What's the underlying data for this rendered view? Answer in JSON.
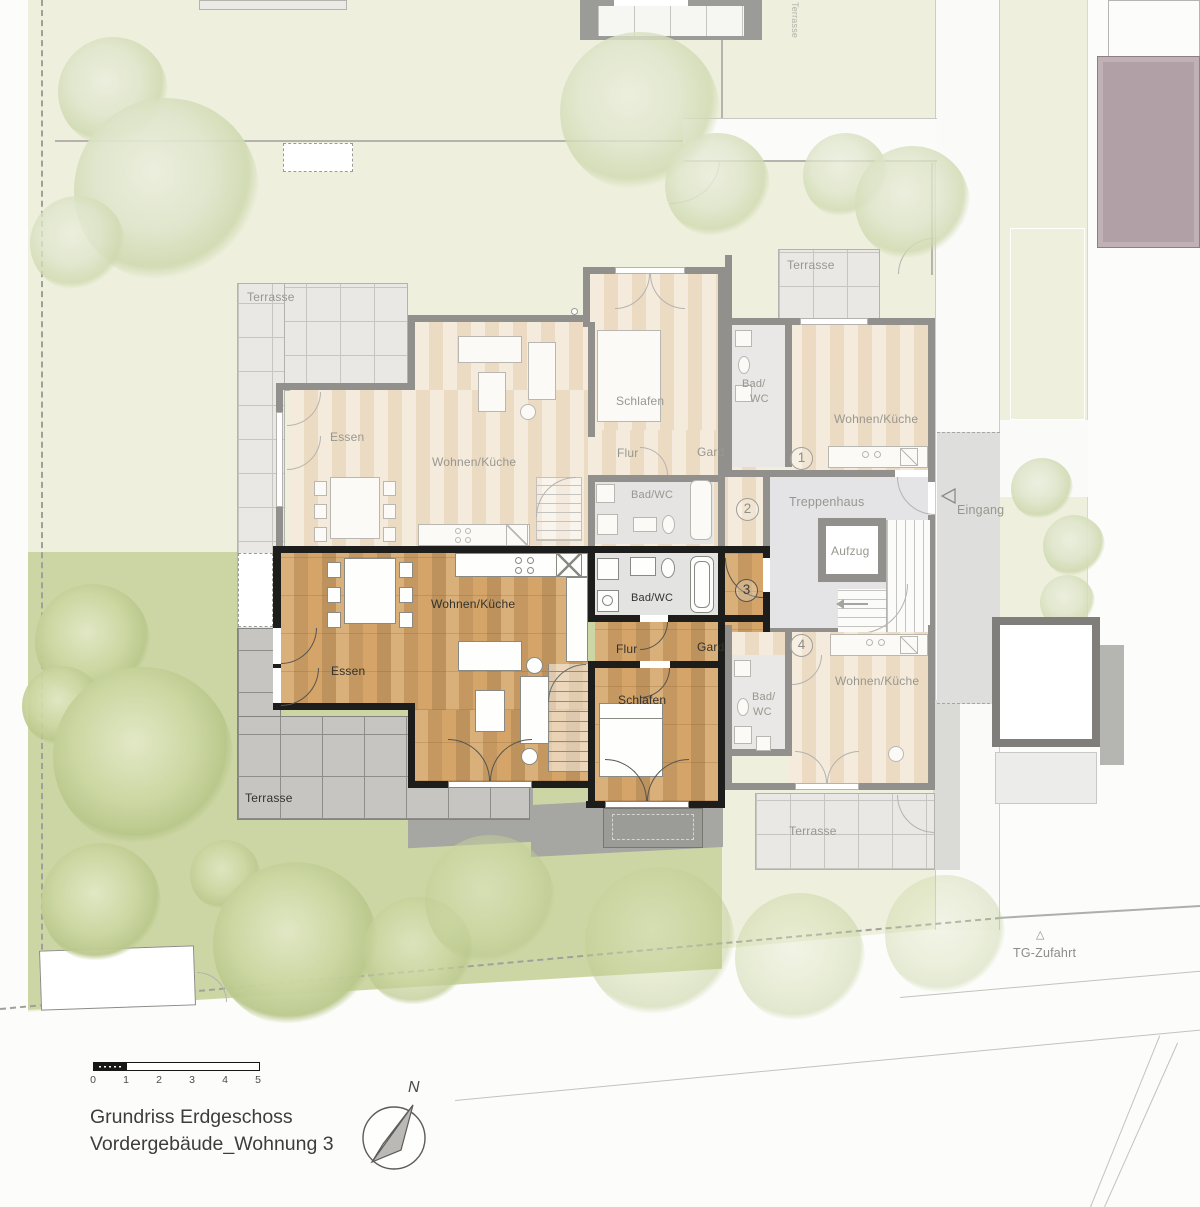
{
  "colors": {
    "garden_pale": "#eef0dd",
    "garden_rich": "#ccd6a4",
    "wood_floor": "#d4a468",
    "faded_floor": "#f1e3cf",
    "active_wall": "#1d1d1b",
    "faded_wall": "#92908c",
    "mauve_building": "#b1a0a6",
    "terrace_tile_dark": "#c6c5c1"
  },
  "site": {
    "eingang_label": "Eingang",
    "tg_zufahrt_label": "TG-Zufahrt",
    "tg_marker_glyph": "△",
    "neighbor_terrace_label": "Terrasse"
  },
  "core": {
    "treppenhaus_label": "Treppenhaus",
    "aufzug_label": "Aufzug"
  },
  "apartment1": {
    "number": "1",
    "terrasse_label": "Terrasse",
    "bad_line1": "Bad/",
    "bad_line2": "WC",
    "wohnen_label": "Wohnen/Küche"
  },
  "apartment2": {
    "number": "2",
    "terrasse_label": "Terrasse",
    "essen_label": "Essen",
    "wohnen_label": "Wohnen/Küche",
    "schlafen_label": "Schlafen",
    "flur_label": "Flur",
    "gard_label": "Gard/Diele",
    "bad_label": "Bad/WC"
  },
  "apartment3": {
    "number": "3",
    "terrasse_label": "Terrasse",
    "essen_label": "Essen",
    "wohnen_label": "Wohnen/Küche",
    "schlafen_label": "Schlafen",
    "flur_label": "Flur",
    "gard_label": "Gard/Diele",
    "bad_label": "Bad/WC"
  },
  "apartment4": {
    "number": "4",
    "terrasse_label": "Terrasse",
    "wohnen_label": "Wohnen/Küche",
    "bad_line1": "Bad/",
    "bad_line2": "WC"
  },
  "legend": {
    "title_line1": "Grundriss Erdgeschoss",
    "title_line2": "Vordergebäude_Wohnung 3",
    "north_label": "N",
    "scale_ticks": [
      "0",
      "1",
      "2",
      "3",
      "4",
      "5"
    ]
  }
}
